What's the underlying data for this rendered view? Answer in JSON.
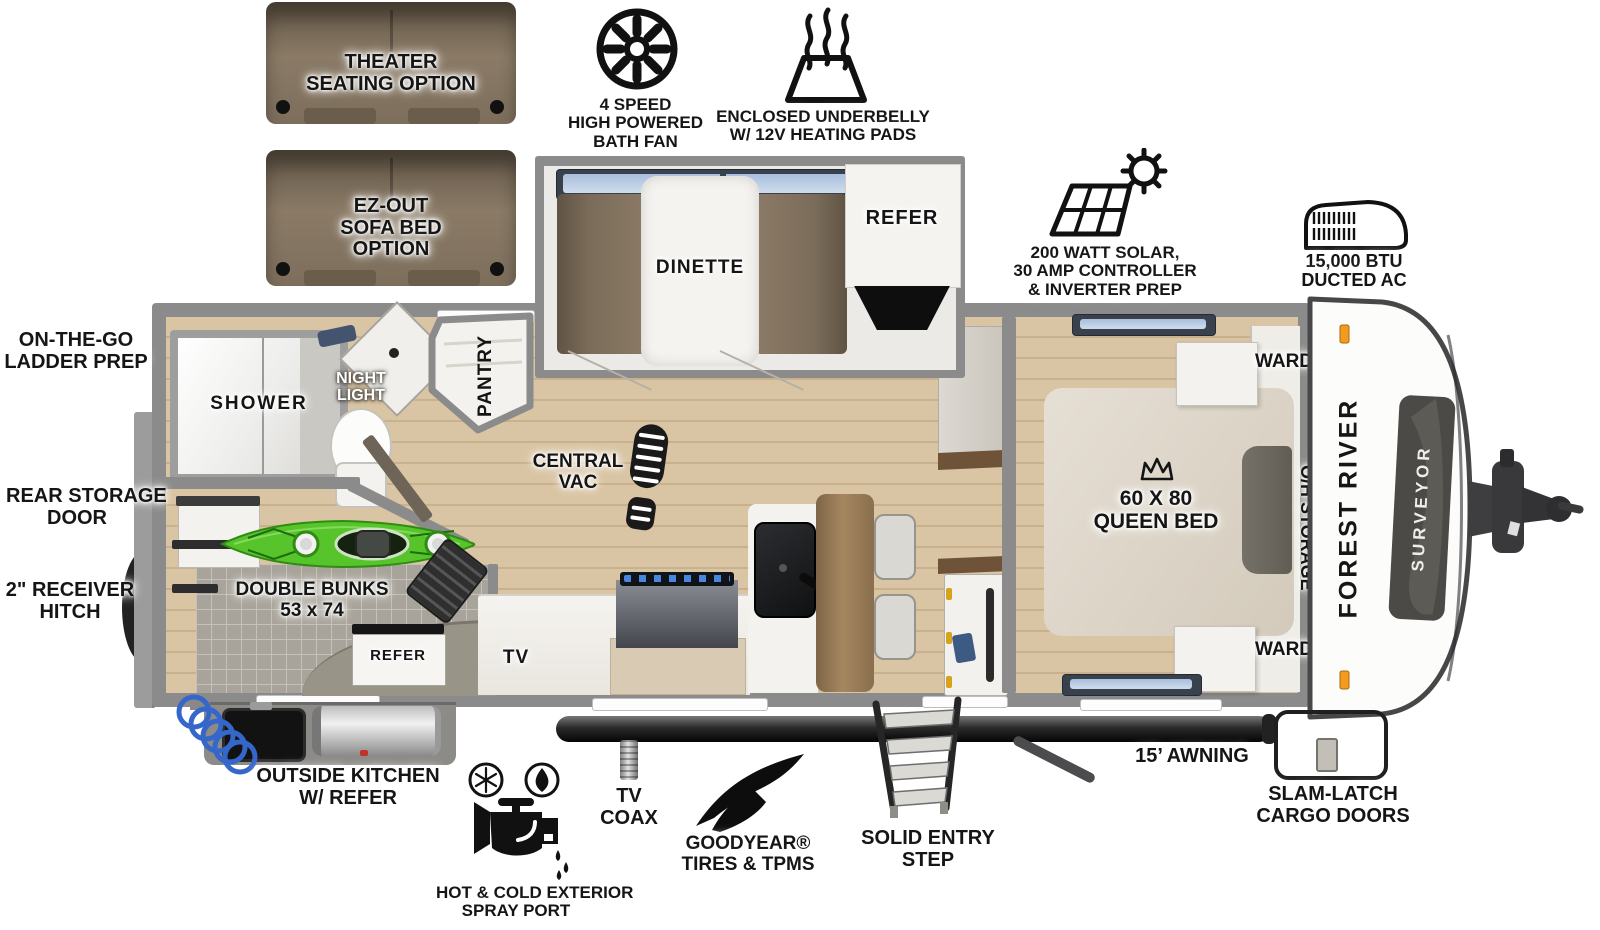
{
  "title": "Forest River Surveyor travel trailer floorplan",
  "colors": {
    "wall": "#8b8b8b",
    "floor": "#d9c4a3",
    "tile": "#a9a49b",
    "kayak_green": "#57c42c",
    "sofa_brown": "#7d6e5c",
    "ink": "#141414",
    "marker_orange": "#f49a1f"
  },
  "options": {
    "theater_seating": {
      "line1": "THEATER",
      "line2": "SEATING OPTION"
    },
    "sofa_bed": {
      "line1": "EZ-OUT",
      "line2": "SOFA BED",
      "line3": "OPTION"
    }
  },
  "features": {
    "bath_fan": {
      "line1": "4 SPEED",
      "line2": "HIGH POWERED",
      "line3": "BATH FAN"
    },
    "underbelly": {
      "line1": "ENCLOSED UNDERBELLY",
      "line2": "W/ 12V HEATING PADS"
    },
    "solar": {
      "line1": "200 WATT SOLAR,",
      "line2": "30 AMP CONTROLLER",
      "line3": "& INVERTER PREP"
    },
    "ac": {
      "line1": "15,000 BTU",
      "line2": "DUCTED AC"
    }
  },
  "exterior": {
    "ladder_prep": {
      "line1": "ON-THE-GO",
      "line2": "LADDER PREP"
    },
    "rear_storage": {
      "line1": "REAR STORAGE",
      "line2": "DOOR"
    },
    "receiver_hitch": {
      "line1": "2\" RECEIVER",
      "line2": "HITCH"
    },
    "outside_kitchen": {
      "line1": "OUTSIDE KITCHEN",
      "line2": "W/ REFER"
    },
    "spray_port": {
      "line1": "HOT & COLD EXTERIOR",
      "line2": "SPRAY PORT"
    },
    "tv_coax": {
      "line1": "TV",
      "line2": "COAX"
    },
    "tires": {
      "line1": "GOODYEAR®",
      "line2": "TIRES & TPMS"
    },
    "entry_step": {
      "line1": "SOLID ENTRY",
      "line2": "STEP"
    },
    "awning": "15’ AWNING",
    "cargo_doors": {
      "line1": "SLAM-LATCH",
      "line2": "CARGO DOORS"
    }
  },
  "interior": {
    "dinette": "DINETTE",
    "refer": "REFER",
    "pantry": "PANTRY",
    "shower": "SHOWER",
    "night_light": {
      "line1": "NIGHT",
      "line2": "LIGHT"
    },
    "central_vac": {
      "line1": "CENTRAL",
      "line2": "VAC"
    },
    "double_bunks": {
      "line1": "DOUBLE BUNKS",
      "line2": "53 x 74"
    },
    "outside_refer": "REFER",
    "tv": "TV",
    "queen_bed": {
      "line1": "60 X 80",
      "line2": "QUEEN BED"
    },
    "ward_front_top": "WARD",
    "ward_front_bottom": "WARD",
    "oh_storage": "O/H STORAGE"
  },
  "branding": {
    "make": "FOREST RIVER",
    "model": "SURVEYOR"
  }
}
